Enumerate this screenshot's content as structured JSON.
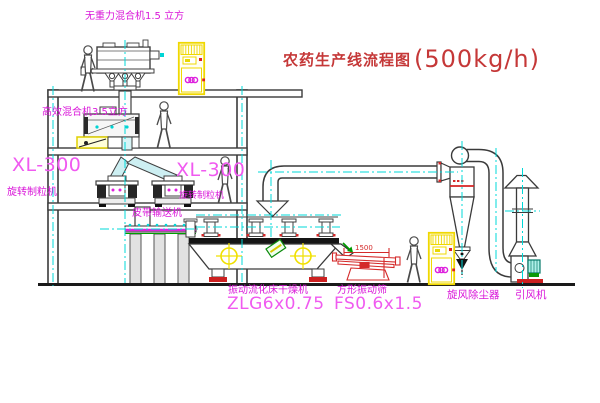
{
  "title": {
    "text_zh": "农药生产线流程图",
    "capacity": "(500kg/h)"
  },
  "labels": {
    "gravity_mixer": "无重力混合机1.5 立方",
    "high_efficiency_mixer": "高效混合机3.5立方",
    "granulator_left_model": "XL-300",
    "granulator_left_name": "旋转制粒机",
    "granulator_mid_model": "XL-300",
    "granulator_mid_name": "旋转制粒机",
    "belt_conveyor": "皮带输送机",
    "fluid_bed_dryer_name": "振动流化床干燥机",
    "fluid_bed_dryer_model": "ZLG6x0.75",
    "vibrating_screen_name": "方形振动筛",
    "vibrating_screen_model": "FS0.6x1.5",
    "cyclone": "旋风除尘器",
    "induced_draft_fan": "引风机"
  },
  "dimensions": {
    "screen_width": "1500"
  },
  "colors": {
    "label_magenta": "#d916d9",
    "model_magenta": "#f05af0",
    "title_red": "#c53838",
    "centerline_cyan": "#00d8d8",
    "cabinet_yellow": "#f0d800",
    "detail_red": "#d42a2a",
    "detail_green": "#009900"
  }
}
